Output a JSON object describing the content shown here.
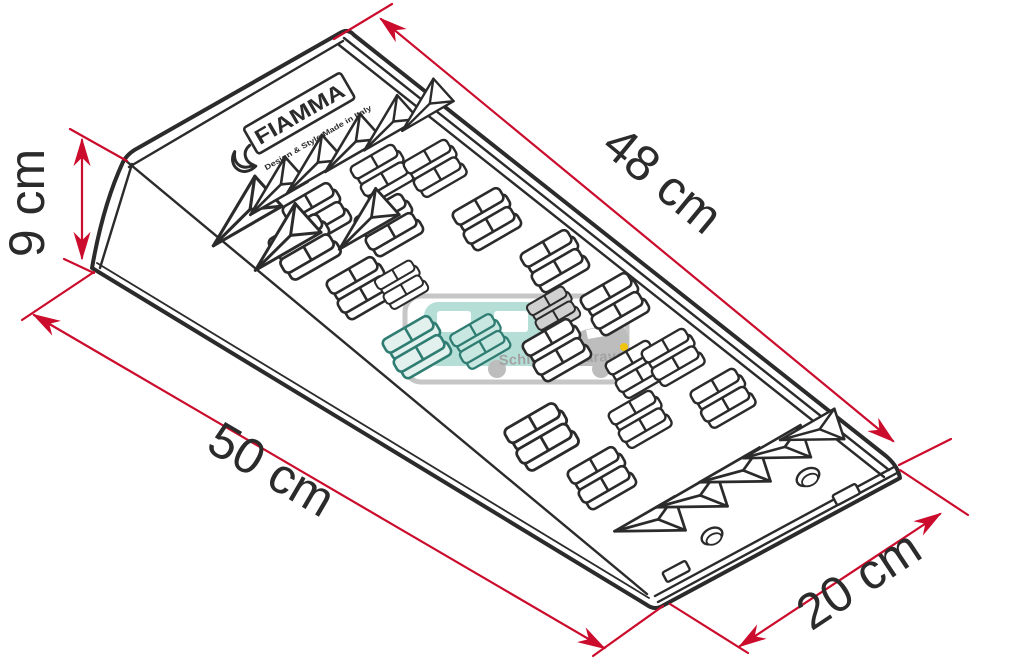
{
  "figure": {
    "alt": "Technical line drawing of a wedge-shaped leveling ramp with dimension arrows"
  },
  "brand": {
    "name": "FIAMMA",
    "tagline": "Design & Style Made in Italy"
  },
  "watermark": {
    "text": "Schippers-caravans.nl"
  },
  "dimensions": {
    "slope_length": {
      "label": "48 cm"
    },
    "height": {
      "label": "9 cm"
    },
    "base_length": {
      "label": "50 cm"
    },
    "width": {
      "label": "20 cm"
    }
  },
  "colors": {
    "line": "#2b2b2b",
    "dimension_red": "#cb0c2c",
    "watermark_frame": "#c6c6c6",
    "watermark_teal": "#b5ded7",
    "watermark_teal_dark": "#2f7d72",
    "watermark_gray": "#bdbdbd",
    "watermark_text": "#a3a3a3",
    "headlight_yellow": "#f0c40a",
    "tint_teal": "#c8e7e1",
    "tint_teal_light": "#e2f1ed",
    "tint_gray": "#d0d0d0"
  }
}
